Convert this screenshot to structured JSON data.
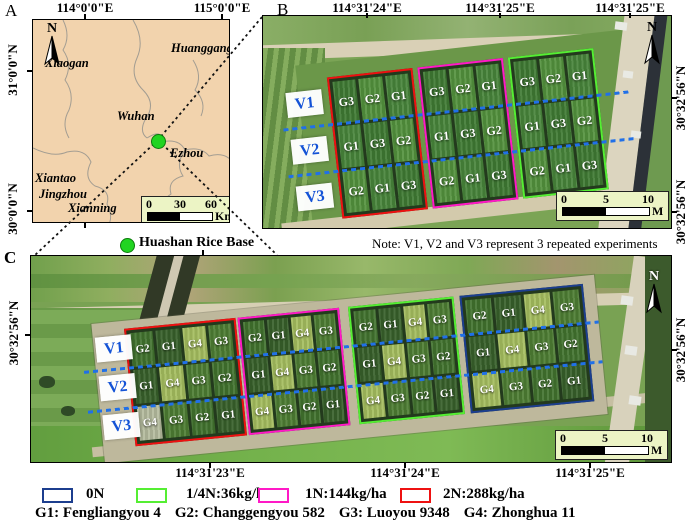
{
  "panelA": {
    "label": "A",
    "north_label": "N",
    "top_coords": [
      "114°0'0\"E",
      "115°0'0\"E"
    ],
    "left_coords": [
      "31°0'0\"N",
      "30°0'0\"N"
    ],
    "cities": [
      "Xiaogan",
      "Huanggang",
      "Wuhan",
      "Ezhou",
      "Xiantao",
      "Jingzhou",
      "Xianning"
    ],
    "scalebar": {
      "ticks": [
        "0",
        "30",
        "60"
      ],
      "unit": "Km"
    },
    "site_legend": {
      "label": "Huashan Rice Base",
      "marker_color": "#21d421"
    }
  },
  "panelB": {
    "label": "B",
    "north_label": "N",
    "top_coords": [
      "114°31'24\"E",
      "114°31'25\"E",
      "114°31'25\"E"
    ],
    "right_coords": [
      "30°32'56\"N",
      "30°32'56\"N"
    ],
    "replicates": [
      "V1",
      "V2",
      "V3"
    ],
    "note": "Note: V1, V2 and V3 represent 3 repeated experiments",
    "scalebar": {
      "ticks": [
        "0",
        "5",
        "10"
      ],
      "unit": "M"
    },
    "blocks": [
      {
        "treatment": "2N:288kg/ha",
        "color": "#ee1111",
        "rows": [
          [
            "G3",
            "G2",
            "G1"
          ],
          [
            "G1",
            "G3",
            "G2"
          ],
          [
            "G2",
            "G1",
            "G3"
          ]
        ]
      },
      {
        "treatment": "1N:144kg/ha",
        "color": "#ff19c6",
        "rows": [
          [
            "G3",
            "G2",
            "G1"
          ],
          [
            "G1",
            "G3",
            "G2"
          ],
          [
            "G2",
            "G1",
            "G3"
          ]
        ]
      },
      {
        "treatment": "1/4N:36kg/ha",
        "color": "#55ee33",
        "rows": [
          [
            "G3",
            "G2",
            "G1"
          ],
          [
            "G1",
            "G3",
            "G2"
          ],
          [
            "G2",
            "G1",
            "G3"
          ]
        ]
      }
    ]
  },
  "panelC": {
    "label": "C",
    "north_label": "N",
    "bottom_coords": [
      "114°31'23\"E",
      "114°31'24\"E",
      "114°31'25\"E"
    ],
    "left_coords": [
      "30°32'56\"N"
    ],
    "right_coords": [
      "30°32'56\"N"
    ],
    "replicates": [
      "V1",
      "V2",
      "V3"
    ],
    "scalebar": {
      "ticks": [
        "0",
        "5",
        "10"
      ],
      "unit": "M"
    },
    "blocks": [
      {
        "treatment": "2N:288kg/ha",
        "color": "#ee1111",
        "rows": [
          [
            "G2",
            "G1",
            "G4",
            "G3"
          ],
          [
            "G1",
            "G4",
            "G3",
            "G2"
          ],
          [
            "G4",
            "G3",
            "G2",
            "G1"
          ]
        ]
      },
      {
        "treatment": "1N:144kg/ha",
        "color": "#ff19c6",
        "rows": [
          [
            "G2",
            "G1",
            "G4",
            "G3"
          ],
          [
            "G1",
            "G4",
            "G3",
            "G2"
          ],
          [
            "G4",
            "G3",
            "G2",
            "G1"
          ]
        ]
      },
      {
        "treatment": "1/4N:36kg/ha",
        "color": "#55ee33",
        "rows": [
          [
            "G2",
            "G1",
            "G4",
            "G3"
          ],
          [
            "G1",
            "G4",
            "G3",
            "G2"
          ],
          [
            "G4",
            "G3",
            "G2",
            "G1"
          ]
        ]
      },
      {
        "treatment": "0N",
        "color": "#1c3e8e",
        "rows": [
          [
            "G2",
            "G1",
            "G4",
            "G3"
          ],
          [
            "G1",
            "G4",
            "G3",
            "G2"
          ],
          [
            "G4",
            "G3",
            "G2",
            "G1"
          ]
        ]
      }
    ]
  },
  "legend": {
    "items": [
      {
        "label": "0N",
        "color": "#1c3e8e"
      },
      {
        "label": "1/4N:36kg/ha",
        "color": "#55ee33"
      },
      {
        "label": "1N:144kg/ha",
        "color": "#ff19c6"
      },
      {
        "label": "2N:288kg/ha",
        "color": "#ee1111"
      }
    ],
    "varieties": [
      "G1: Fengliangyou 4",
      "G2: Changgengyou 582",
      "G3: Luoyou 9348",
      "G4: Zhonghua 11"
    ]
  }
}
